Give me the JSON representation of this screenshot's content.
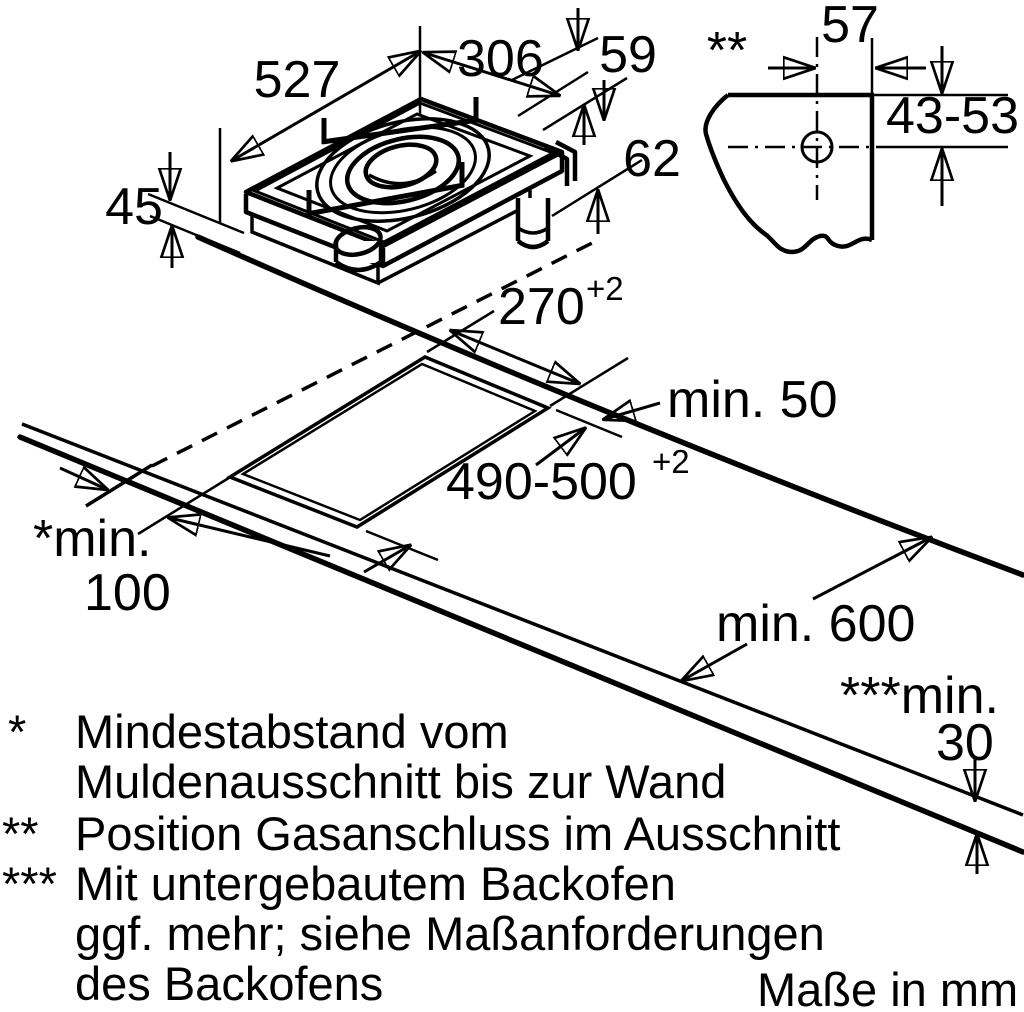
{
  "title": "Gas hob installation drawing",
  "units_note": "Maße in mm",
  "hob": {
    "length": "527",
    "width": "306",
    "grate_height": "59",
    "total_height": "62",
    "builtin_depth": "45"
  },
  "gas": {
    "marker": "**",
    "dist_from_right": "57",
    "dist_from_top": "43-53"
  },
  "cutout": {
    "width": "270",
    "width_tol": "+2",
    "length": "490-500",
    "length_tol": "+2",
    "front_clearance": "min. 50",
    "wall_clearance_label": "*min.",
    "wall_clearance_value": "100",
    "worktop_depth": "min. 600",
    "thickness_label": "***min.",
    "thickness_value": "30"
  },
  "footnotes": [
    {
      "marker": "*",
      "line1": "Mindestabstand vom",
      "line2": "Muldenausschnitt bis zur Wand"
    },
    {
      "marker": "**",
      "line1": "Position Gasanschluss im Ausschnitt"
    },
    {
      "marker": "***",
      "line1": "Mit untergebautem Backofen",
      "line2": "ggf. mehr; siehe Maßanforderungen",
      "line3": "des Backofens"
    }
  ],
  "colors": {
    "line": "#000000",
    "background": "#ffffff",
    "burner_ring": "#c6c6c6",
    "burner_cap": "#e0e0e0"
  }
}
